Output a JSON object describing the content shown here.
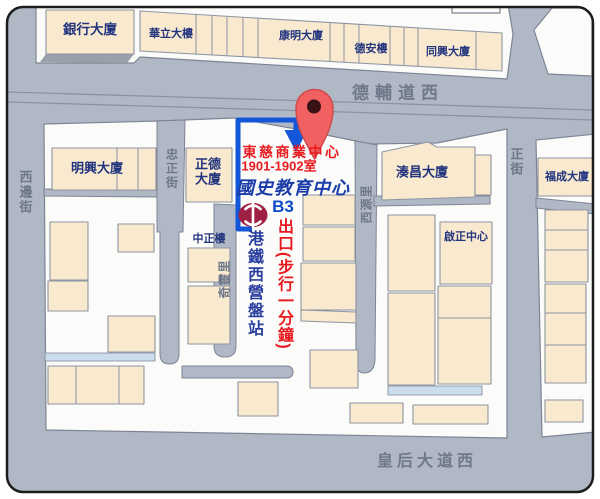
{
  "map": {
    "title": "國史教育中心位置地圖",
    "streets": {
      "des_voeux_west": "德輔道西",
      "queens_west": "皇后大道西",
      "western": "西邊街",
      "chung_ching": "忠正街",
      "centre": "正街",
      "sai_yuen_lane": "西源里",
      "ki_ling_lane": "奇靈里"
    },
    "buildings": {
      "bank": "銀行大廈",
      "wah_lap": "華立大樓",
      "hong_ming": "康明大廈",
      "tak_on": "德安樓",
      "tung_hing": "同興大廈",
      "ming_hing": "明興大廈",
      "ching_tak": "正德大廈",
      "chung_ching_house": "中正樓",
      "tsau_cheong": "湊昌大廈",
      "fook_shing": "福成大廈",
      "kai_ching": "啟正中心"
    },
    "destination": {
      "building": "東慈商業中心",
      "room": "1901-1902室",
      "org": "國史教育中心"
    },
    "mtr": {
      "exit_code": "B3",
      "exit_note": "出口(步行一分鐘)",
      "station": "港鐵西營盤站"
    },
    "colors": {
      "road": "#b1b8c5",
      "lot": "#fbfbf9",
      "building": "#f8e9cf",
      "building_text": "#22357e",
      "street_text": "#6f7889",
      "highlight_red": "#e8191f",
      "org_blue": "#1b3ca9",
      "route_blue": "#1456d8",
      "mtr_red": "#9e2143",
      "pin_red": "#f16161"
    }
  }
}
